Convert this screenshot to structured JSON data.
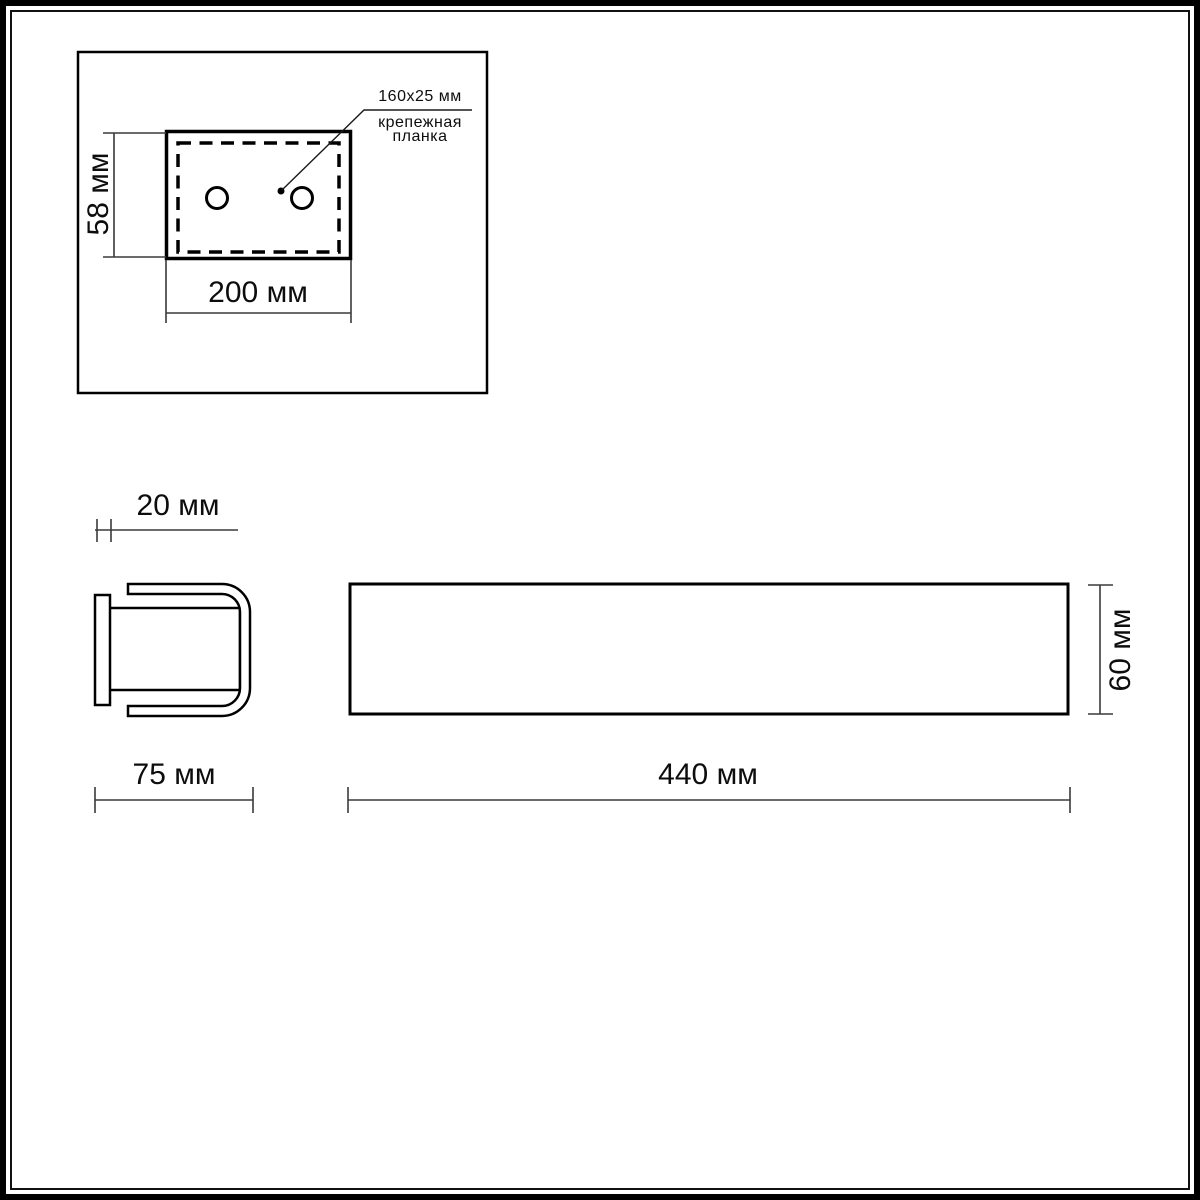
{
  "diagram": {
    "title_note": "",
    "top_view": {
      "height_label": "58 мм",
      "width_label": "200 мм",
      "callout_size": "160x25 мм",
      "callout_name_line1": "крепежная",
      "callout_name_line2": "планка"
    },
    "side_view": {
      "plate_depth_label": "20 мм",
      "total_depth_label": "75 мм"
    },
    "front_view": {
      "length_label": "440 мм",
      "height_label": "60 мм"
    },
    "colors": {
      "outline": "#000000",
      "dimension_line": "#3a3a3a",
      "background": "#ffffff"
    }
  }
}
